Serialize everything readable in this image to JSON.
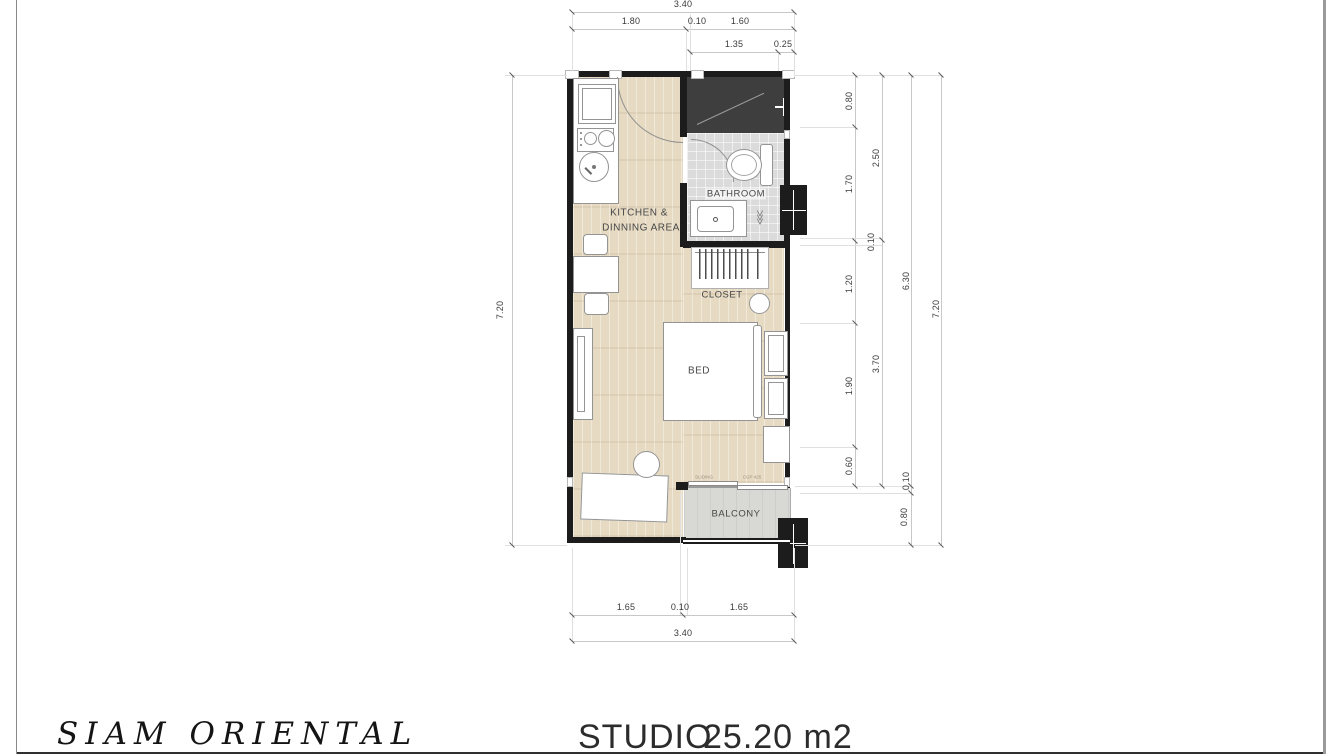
{
  "footer": {
    "brand": "SIAM ORIENTAL",
    "unit_type": "STUDIO",
    "area": "25.20 m2"
  },
  "rooms": {
    "kitchen_line1": "KITCHEN &",
    "kitchen_line2": "DINNING AREA",
    "bathroom": "BATHROOM",
    "closet": "CLOSET",
    "bed": "BED",
    "balcony": "BALCONY"
  },
  "door_labels": {
    "sliding": "SLIDING",
    "code": "CGP 425"
  },
  "dims": {
    "top": {
      "overall": "3.40",
      "row2": [
        "1.80",
        "0.10",
        "1.60"
      ],
      "row3": [
        "1.35",
        "0.25"
      ]
    },
    "bottom": {
      "row1": [
        "1.65",
        "0.10",
        "1.65"
      ],
      "overall": "3.40"
    },
    "left": {
      "overall": "7.20"
    },
    "right": {
      "chain_a": [
        "0.80",
        "1.70",
        "1.20",
        "1.90",
        "0.60"
      ],
      "chain_b": [
        "2.50",
        "0.10",
        "3.70"
      ],
      "chain_c": [
        "6.30",
        "0.10",
        "0.80"
      ],
      "overall": "7.20"
    }
  },
  "colors": {
    "wall": "#1c1c1c",
    "wood_floor": "#e6dac2",
    "bathroom_tile": "#dbdbdb",
    "shower_dark": "#3e3e3e",
    "balcony_floor": "#d8d8d4"
  }
}
